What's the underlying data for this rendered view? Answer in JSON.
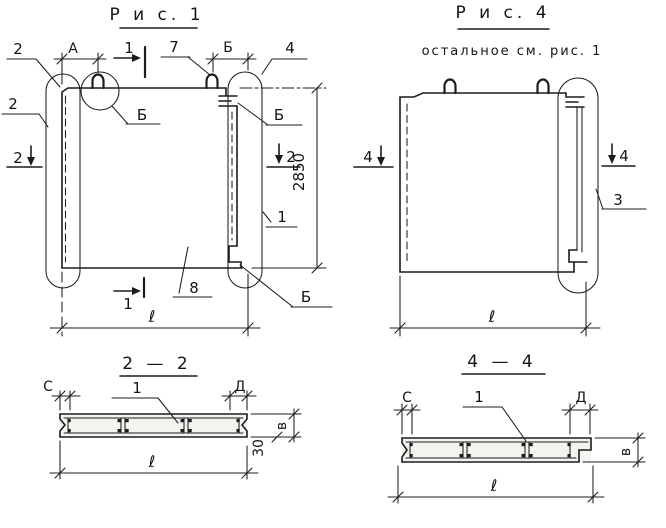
{
  "figure1": {
    "title": "Р и с.  1",
    "callout_2_top": "2",
    "callout_2_left": "2",
    "callout_7": "7",
    "callout_4": "4",
    "callout_detail_left": "Б",
    "callout_detail_right": "Б",
    "callout_detail_bottom": "Б",
    "callout_1": "1",
    "callout_8": "8",
    "dim_A": "А",
    "dim_B": "Б",
    "dim_height": "2850",
    "dim_length": "ℓ",
    "marker_section1_top": "1",
    "marker_section1_bottom": "1",
    "marker_section2_left": "2",
    "marker_section2_right": "2"
  },
  "figure4": {
    "title": "Р и с.  4",
    "subtitle": "остальное    см. рис. 1",
    "callout_3": "3",
    "dim_length": "ℓ",
    "marker_section4_left": "4",
    "marker_section4_right": "4"
  },
  "section22": {
    "title": "2 — 2",
    "dim_C": "С",
    "dim_D": "Д",
    "callout_1": "1",
    "dim_thickness": "в",
    "dim_depth": "30",
    "dim_length": "ℓ"
  },
  "section44": {
    "title": "4 — 4",
    "dim_C": "С",
    "dim_D": "Д",
    "callout_1": "1",
    "dim_thickness": "в",
    "dim_length": "ℓ"
  }
}
